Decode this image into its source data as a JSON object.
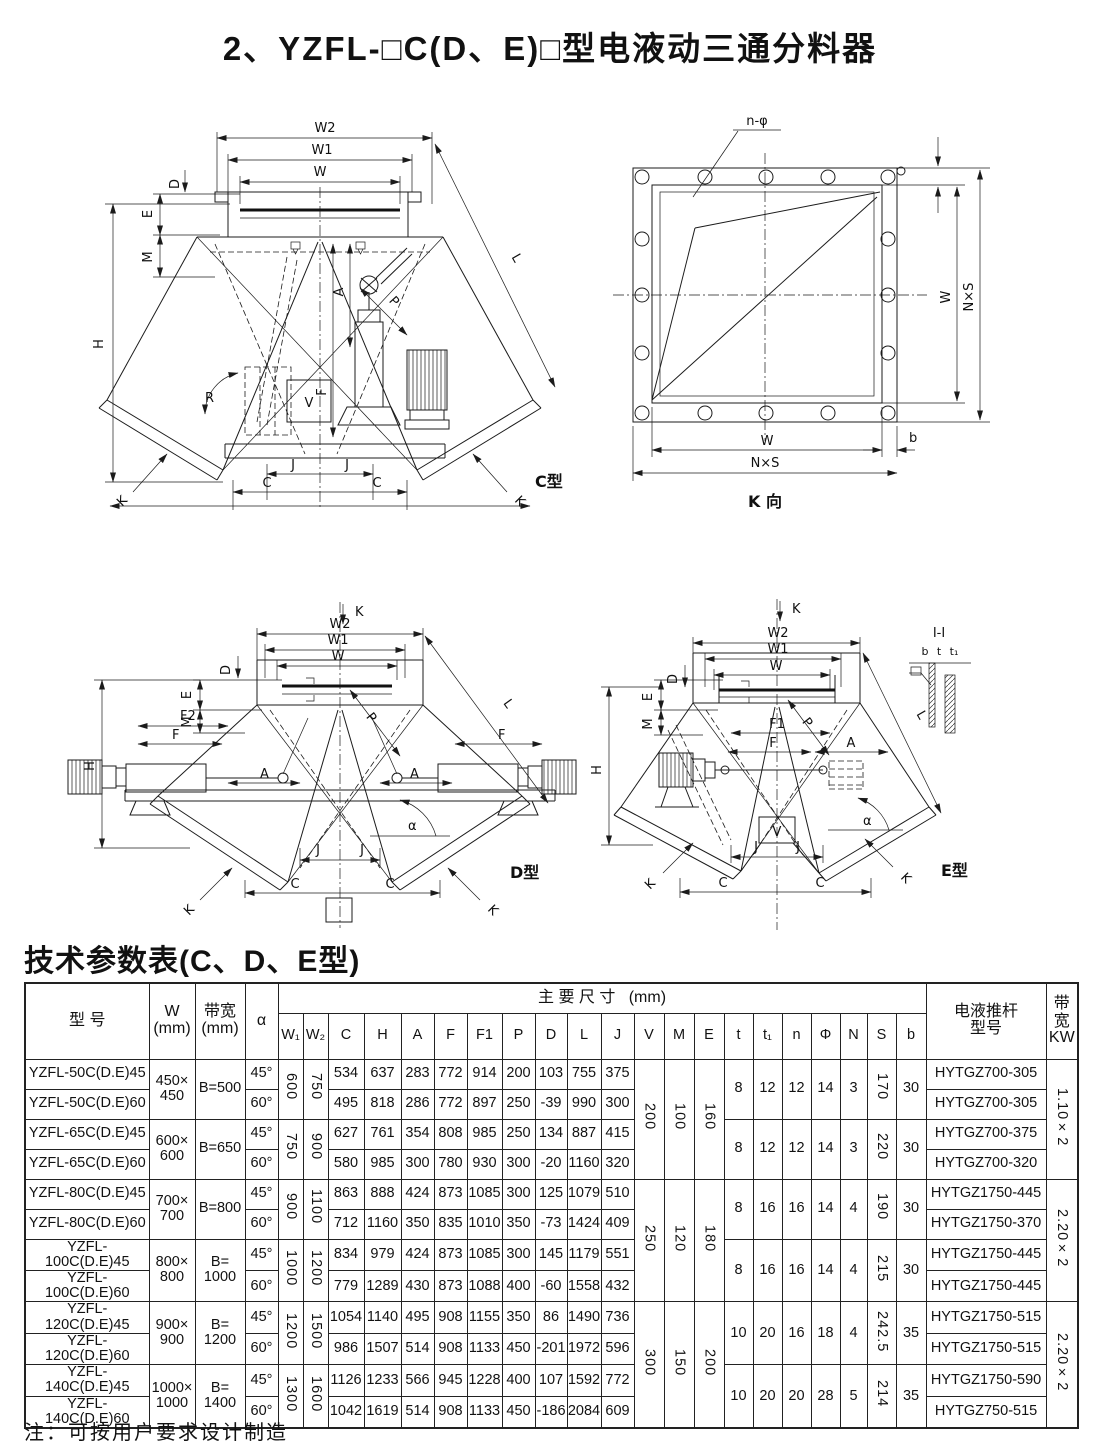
{
  "page": {
    "title": "2、YZFL-□C(D、E)□型电液动三通分料器",
    "note": "注：可按用户要求设计制造"
  },
  "dims": {
    "w2": "W2",
    "w1": "W1",
    "w": "W",
    "d": "D",
    "e": "E",
    "m": "M",
    "h": "H",
    "l": "L",
    "a": "A",
    "f": "F",
    "f1": "F1",
    "f2": "F2",
    "p": "P",
    "r": "R",
    "v": "V",
    "j": "J",
    "c": "C",
    "k": "K",
    "alpha": "α",
    "n_phi": "n-φ",
    "nxs": "N×S",
    "b": "b",
    "t": "t",
    "t1": "t₁",
    "ii": "I-I",
    "k_view": "K 向"
  },
  "captions": {
    "c": "C型",
    "d": "D型",
    "e": "E型"
  },
  "table": {
    "heading": "技术参数表(C、D、E型)",
    "header": {
      "model": "型  号",
      "w": "W",
      "mm": "(mm)",
      "bandwidth": "带宽",
      "alpha": "α",
      "main_dims": "主 要 尺 寸",
      "main_dims_unit": "(mm)",
      "dim_cols": [
        "W₁",
        "W₂",
        "C",
        "H",
        "A",
        "F",
        "F1",
        "P",
        "D",
        "L",
        "J",
        "V",
        "M",
        "E",
        "t",
        "t₁",
        "n",
        "Φ",
        "N",
        "S",
        "b"
      ],
      "pusher_l1": "电液推杆",
      "pusher_l2": "型号",
      "kw_label": "带宽",
      "kw_unit": "KW"
    },
    "super_groups": [
      {
        "v": "200",
        "m": "100",
        "e": "160",
        "kw": "1.10×2",
        "groups": [
          {
            "w": "450×450",
            "bandwidth": "B=500",
            "w1": "600",
            "w2": "750",
            "bolt": {
              "t": "8",
              "t1": "12",
              "n": "12",
              "phi": "14",
              "nn": "3",
              "s": "170",
              "b": "30"
            },
            "rows": [
              {
                "model": "YZFL-50C(D.E)45",
                "alpha": "45°",
                "c": "534",
                "h": "637",
                "a": "283",
                "f": "772",
                "f1": "914",
                "p": "200",
                "d": "103",
                "l": "755",
                "j": "375",
                "pusher": "HYTGZ700-305"
              },
              {
                "model": "YZFL-50C(D.E)60",
                "alpha": "60°",
                "c": "495",
                "h": "818",
                "a": "286",
                "f": "772",
                "f1": "897",
                "p": "250",
                "d": "-39",
                "l": "990",
                "j": "300",
                "pusher": "HYTGZ700-305"
              }
            ]
          },
          {
            "w": "600×600",
            "bandwidth": "B=650",
            "w1": "750",
            "w2": "900",
            "bolt": {
              "t": "8",
              "t1": "12",
              "n": "12",
              "phi": "14",
              "nn": "3",
              "s": "220",
              "b": "30"
            },
            "rows": [
              {
                "model": "YZFL-65C(D.E)45",
                "alpha": "45°",
                "c": "627",
                "h": "761",
                "a": "354",
                "f": "808",
                "f1": "985",
                "p": "250",
                "d": "134",
                "l": "887",
                "j": "415",
                "pusher": "HYTGZ700-375"
              },
              {
                "model": "YZFL-65C(D.E)60",
                "alpha": "60°",
                "c": "580",
                "h": "985",
                "a": "300",
                "f": "780",
                "f1": "930",
                "p": "300",
                "d": "-20",
                "l": "1160",
                "j": "320",
                "pusher": "HYTGZ700-320"
              }
            ]
          }
        ]
      },
      {
        "v": "250",
        "m": "120",
        "e": "180",
        "kw": "2.20×2",
        "groups": [
          {
            "w": "700×700",
            "bandwidth": "B=800",
            "w1": "900",
            "w2": "1100",
            "bolt": {
              "t": "8",
              "t1": "16",
              "n": "16",
              "phi": "14",
              "nn": "4",
              "s": "190",
              "b": "30"
            },
            "rows": [
              {
                "model": "YZFL-80C(D.E)45",
                "alpha": "45°",
                "c": "863",
                "h": "888",
                "a": "424",
                "f": "873",
                "f1": "1085",
                "p": "300",
                "d": "125",
                "l": "1079",
                "j": "510",
                "pusher": "HYTGZ1750-445"
              },
              {
                "model": "YZFL-80C(D.E)60",
                "alpha": "60°",
                "c": "712",
                "h": "1160",
                "a": "350",
                "f": "835",
                "f1": "1010",
                "p": "350",
                "d": "-73",
                "l": "1424",
                "j": "409",
                "pusher": "HYTGZ1750-370"
              }
            ]
          },
          {
            "w": "800×800",
            "bandwidth": "B=1000",
            "w1": "1000",
            "w2": "1200",
            "bolt": {
              "t": "8",
              "t1": "16",
              "n": "16",
              "phi": "14",
              "nn": "4",
              "s": "215",
              "b": "30"
            },
            "rows": [
              {
                "model": "YZFL-100C(D.E)45",
                "alpha": "45°",
                "c": "834",
                "h": "979",
                "a": "424",
                "f": "873",
                "f1": "1085",
                "p": "300",
                "d": "145",
                "l": "1179",
                "j": "551",
                "pusher": "HYTGZ1750-445"
              },
              {
                "model": "YZFL-100C(D.E)60",
                "alpha": "60°",
                "c": "779",
                "h": "1289",
                "a": "430",
                "f": "873",
                "f1": "1088",
                "p": "400",
                "d": "-60",
                "l": "1558",
                "j": "432",
                "pusher": "HYTGZ1750-445"
              }
            ]
          }
        ]
      },
      {
        "v": "300",
        "m": "150",
        "e": "200",
        "kw": "2.20×2",
        "groups": [
          {
            "w": "900×900",
            "bandwidth": "B=1200",
            "w1": "1200",
            "w2": "1500",
            "bolt": {
              "t": "10",
              "t1": "20",
              "n": "16",
              "phi": "18",
              "nn": "4",
              "s": "242.5",
              "b": "35"
            },
            "rows": [
              {
                "model": "YZFL-120C(D.E)45",
                "alpha": "45°",
                "c": "1054",
                "h": "1140",
                "a": "495",
                "f": "908",
                "f1": "1155",
                "p": "350",
                "d": "86",
                "l": "1490",
                "j": "736",
                "pusher": "HYTGZ1750-515"
              },
              {
                "model": "YZFL-120C(D.E)60",
                "alpha": "60°",
                "c": "986",
                "h": "1507",
                "a": "514",
                "f": "908",
                "f1": "1133",
                "p": "450",
                "d": "-201",
                "l": "1972",
                "j": "596",
                "pusher": "HYTGZ1750-515"
              }
            ]
          },
          {
            "w": "1000×1000",
            "bandwidth": "B=1400",
            "w1": "1300",
            "w2": "1600",
            "bolt": {
              "t": "10",
              "t1": "20",
              "n": "20",
              "phi": "28",
              "nn": "5",
              "s": "214",
              "b": "35"
            },
            "rows": [
              {
                "model": "YZFL-140C(D.E)45",
                "alpha": "45°",
                "c": "1126",
                "h": "1233",
                "a": "566",
                "f": "945",
                "f1": "1228",
                "p": "400",
                "d": "107",
                "l": "1592",
                "j": "772",
                "pusher": "HYTGZ1750-590"
              },
              {
                "model": "YZFL-140C(D.E)60",
                "alpha": "60°",
                "c": "1042",
                "h": "1619",
                "a": "514",
                "f": "908",
                "f1": "1133",
                "p": "450",
                "d": "-186",
                "l": "2084",
                "j": "609",
                "pusher": "HYTGZ750-515"
              }
            ]
          }
        ]
      }
    ]
  }
}
